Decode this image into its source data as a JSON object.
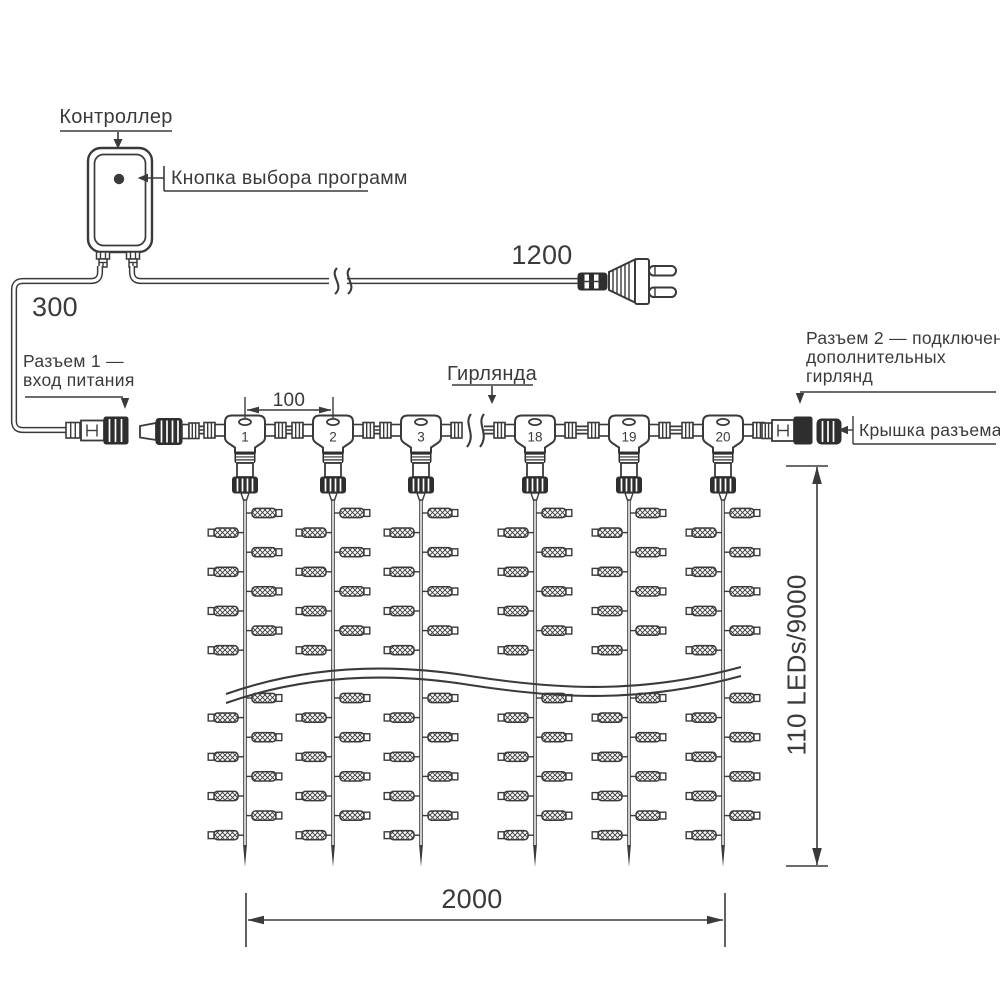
{
  "diagram": {
    "labels": {
      "controller": "Контроллер",
      "program_button": "Кнопка выбора программ",
      "connector1": [
        "Разъем 1 —",
        "вход питания"
      ],
      "connector2": [
        "Разъем 2 — подключение",
        "дополнительных",
        "гирлянд"
      ],
      "connector_cap": "Крышка разъема",
      "garland": "Гирлянда"
    },
    "dimensions": {
      "controller_cable": "300",
      "power_cable": "1200",
      "drop_spacing": "100",
      "curtain_width": "2000",
      "curtain_height": "110 LEDs/9000"
    },
    "drops": {
      "numbers": [
        "1",
        "2",
        "3",
        "18",
        "19",
        "20"
      ]
    },
    "colors": {
      "line": "#3a3a3a",
      "dark_fill": "#2e2e2e",
      "background": "#ffffff"
    }
  }
}
